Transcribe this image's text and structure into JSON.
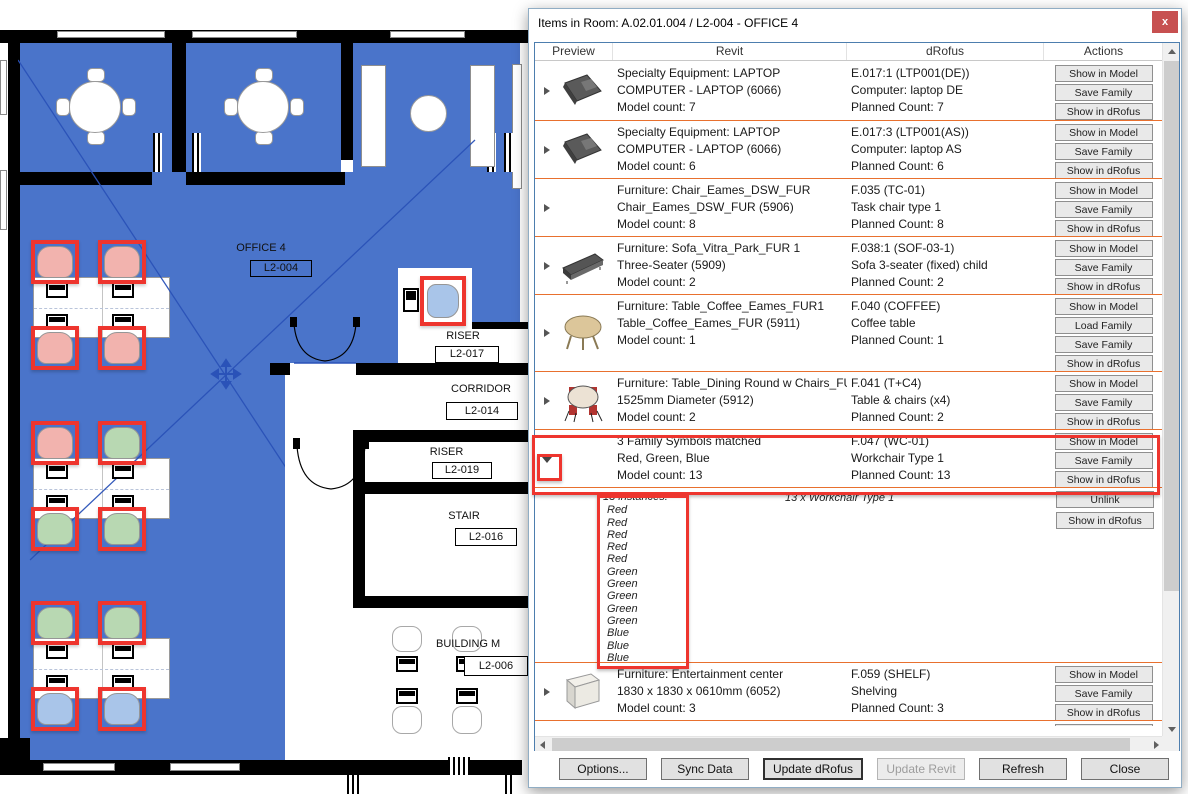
{
  "window": {
    "title": "Items in Room: A.02.01.004 / L2-004 - OFFICE 4",
    "close": "x"
  },
  "list": {
    "headers": [
      "Preview",
      "Revit",
      "dRofus",
      "Actions"
    ]
  },
  "rows": [
    {
      "preview": "laptop",
      "revit": [
        "Specialty Equipment: LAPTOP",
        "COMPUTER - LAPTOP (6066)",
        "Model count: 7"
      ],
      "drofus": [
        "E.017:1 (LTP001(DE))",
        "Computer: laptop DE",
        "Planned Count: 7"
      ],
      "actions": [
        "Show in Model",
        "Save Family",
        "Show in dRofus"
      ]
    },
    {
      "preview": "laptop",
      "revit": [
        "Specialty Equipment: LAPTOP",
        "COMPUTER - LAPTOP (6066)",
        "Model count: 6"
      ],
      "drofus": [
        "E.017:3 (LTP001(AS))",
        "Computer: laptop AS",
        "Planned Count: 6"
      ],
      "actions": [
        "Show in Model",
        "Save Family",
        "Show in dRofus"
      ]
    },
    {
      "preview": "none",
      "revit": [
        "Furniture: Chair_Eames_DSW_FUR",
        "Chair_Eames_DSW_FUR (5906)",
        "Model count: 8"
      ],
      "drofus": [
        "F.035 (TC-01)",
        "Task chair type 1",
        "Planned Count: 8"
      ],
      "actions": [
        "Show in Model",
        "Save Family",
        "Show in dRofus"
      ]
    },
    {
      "preview": "sofa",
      "revit": [
        "Furniture: Sofa_Vitra_Park_FUR 1",
        "Three-Seater (5909)",
        "Model count: 2"
      ],
      "drofus": [
        "F.038:1 (SOF-03-1)",
        "Sofa 3-seater (fixed) child",
        "Planned Count: 2"
      ],
      "actions": [
        "Show in Model",
        "Save Family",
        "Show in dRofus"
      ]
    },
    {
      "preview": "coffee-table",
      "revit": [
        "Furniture: Table_Coffee_Eames_FUR1",
        "Table_Coffee_Eames_FUR (5911)",
        "Model count: 1"
      ],
      "drofus": [
        "F.040 (COFFEE)",
        "Coffee table",
        "Planned Count: 1"
      ],
      "actions": [
        "Show in Model",
        "Load Family",
        "Save Family",
        "Show in dRofus"
      ]
    },
    {
      "preview": "dining-table",
      "revit": [
        "Furniture: Table_Dining Round w Chairs_FU",
        "1525mm Diameter (5912)",
        "Model count: 2"
      ],
      "drofus": [
        "F.041 (T+C4)",
        "Table & chairs (x4)",
        "Planned Count: 2"
      ],
      "actions": [
        "Show in Model",
        "Save Family",
        "Show in dRofus"
      ]
    },
    {
      "preview": "expander-down",
      "revit": [
        "3 Family Symbols matched",
        "Red, Green, Blue",
        "Model count: 13"
      ],
      "drofus": [
        "F.047 (WC-01)",
        "Workchair Type 1",
        "Planned Count: 13"
      ],
      "actions": [
        "Show in Model",
        "Save Family",
        "Show in dRofus"
      ]
    },
    {
      "preview": "shelf",
      "revit": [
        "Furniture: Entertainment center",
        "1830 x 1830 x 0610mm (6052)",
        "Model count: 3"
      ],
      "drofus": [
        "F.059 (SHELF)",
        "Shelving",
        "Planned Count: 3"
      ],
      "actions": [
        "Show in Model",
        "Save Family",
        "Show in dRofus"
      ]
    }
  ],
  "expanded": {
    "instances_label": "13 instances:",
    "instances": [
      "Red",
      "Red",
      "Red",
      "Red",
      "Red",
      "Green",
      "Green",
      "Green",
      "Green",
      "Green",
      "Blue",
      "Blue",
      "Blue"
    ],
    "drofus_note": "13 x Workchair Type 1",
    "actions": [
      "Unlink",
      "Show in dRofus"
    ]
  },
  "footer": {
    "buttons": [
      "Options...",
      "Sync Data",
      "Update dRofus",
      "Update Revit",
      "Refresh",
      "Close"
    ]
  },
  "plan": {
    "rooms": [
      {
        "name": "OFFICE 4",
        "number": "L2-004"
      },
      {
        "name": "RISER",
        "number": "L2-017"
      },
      {
        "name": "CORRIDOR",
        "number": "L2-014"
      },
      {
        "name": "RISER",
        "number": "L2-019"
      },
      {
        "name": "STAIR",
        "number": "L2-016"
      },
      {
        "name": "BUILDING M",
        "number": "L2-006"
      }
    ]
  },
  "colors": {
    "room_highlight": "#4a74ca",
    "annotation_red": "#ee352e",
    "row_separator": "#e8702e",
    "chair_red": "#f2b3ae",
    "chair_green": "#b8d8b2",
    "chair_blue": "#a9c5e9",
    "close_button": "#c75050"
  }
}
